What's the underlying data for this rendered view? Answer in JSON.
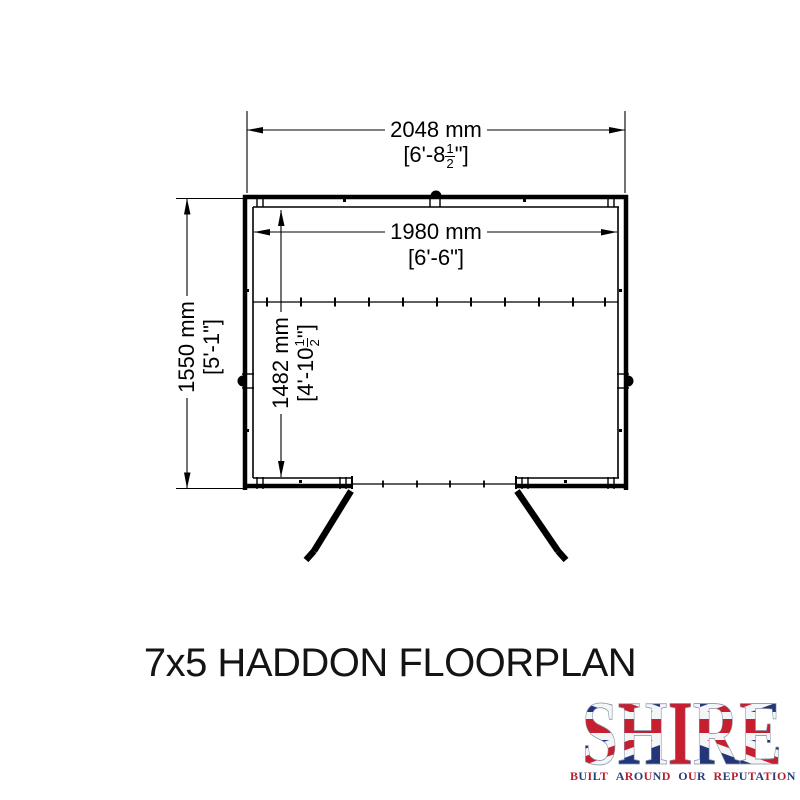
{
  "title": {
    "text": "7x5 HADDON FLOORPLAN"
  },
  "floorplan": {
    "dim_overall_width": {
      "mm": "2048 mm",
      "imp_pre": "[6'-8",
      "frac_num": "1",
      "frac_den": "2",
      "imp_post": "\"]"
    },
    "dim_internal_width": {
      "mm": "1980 mm",
      "imp": "[6'-6\"]"
    },
    "dim_overall_depth": {
      "mm": "1550 mm",
      "imp": "[5'-1\"]"
    },
    "dim_internal_depth": {
      "mm": "1482 mm",
      "imp_pre": "[4'-10",
      "frac_num": "1",
      "frac_den": "2",
      "imp_post": "\"]"
    }
  },
  "logo": {
    "brand": "SHIRE",
    "tagline": "BUILT AROUND OUR REPUTATION",
    "colors": {
      "red": "#b6212f",
      "blue": "#27407c",
      "flag_blue": "#24367a",
      "flag_red": "#c51f30",
      "flag_white": "#f4f5f7"
    }
  }
}
